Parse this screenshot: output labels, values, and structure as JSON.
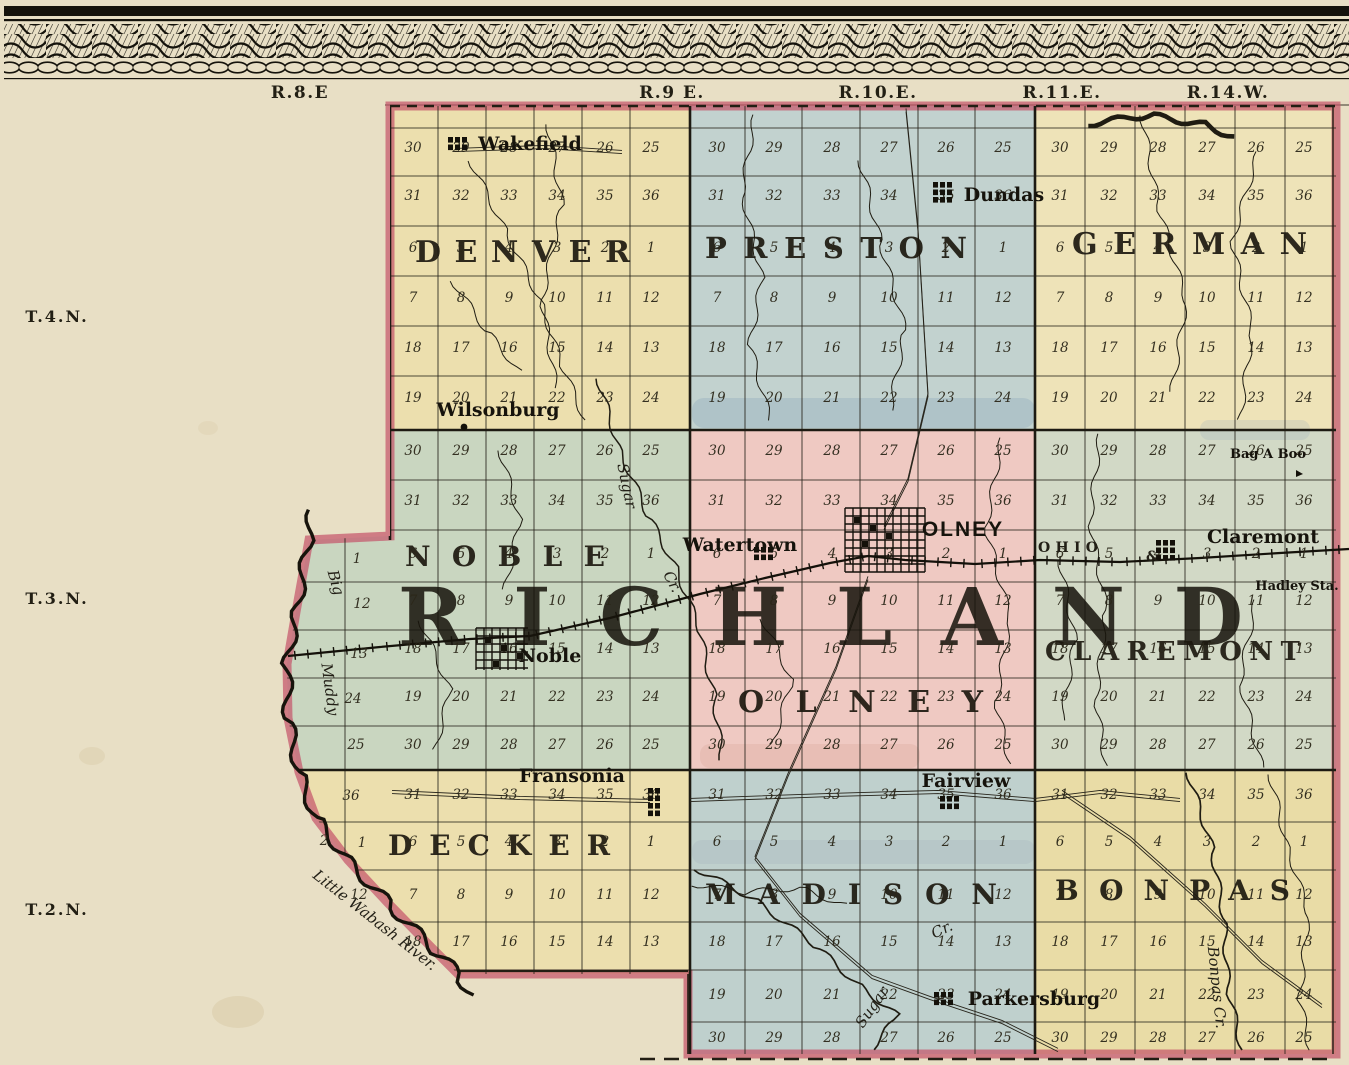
{
  "county_name": "RICHLAND",
  "palette": {
    "paper": "#e8dfc5",
    "ink": "#221e14",
    "red_border": "#c5566b",
    "water_wash": "#8aa3b8"
  },
  "margin": {
    "range_labels": [
      {
        "text": "R.8.E"
      },
      {
        "text": "R.9 E."
      },
      {
        "text": "R.10.E."
      },
      {
        "text": "R.11.E."
      },
      {
        "text": "R.14.W."
      }
    ],
    "township_row_labels": [
      {
        "text": "T.4.N."
      },
      {
        "text": "T.3.N."
      },
      {
        "text": "T.2.N."
      }
    ]
  },
  "townships": [
    {
      "name": "DENVER",
      "color": "#ecdfae"
    },
    {
      "name": "PRESTON",
      "color": "#c2d2cf"
    },
    {
      "name": "GERMAN",
      "color": "#eee3b8"
    },
    {
      "name": "NOBLE",
      "color": "#c9d6c0"
    },
    {
      "name": "OLNEY",
      "color": "#efc9c2"
    },
    {
      "name": "CLAREMONT",
      "color": "#d2d9c6"
    },
    {
      "name": "DECKER",
      "color": "#ecdfae"
    },
    {
      "name": "MADISON",
      "color": "#bfd0cd"
    },
    {
      "name": "BONPAS",
      "color": "#e9dca6"
    }
  ],
  "towns": [
    {
      "name": "Wakefield",
      "lx": 530,
      "ly": 150,
      "cls": "townlbl",
      "sym": "blockgrid",
      "sx": 448,
      "sy": 137,
      "sw": 22,
      "sh": 15
    },
    {
      "name": "Dundas",
      "lx": 1004,
      "ly": 201,
      "cls": "townlbl",
      "sym": "blockgrid",
      "sx": 933,
      "sy": 182,
      "sw": 24,
      "sh": 21
    },
    {
      "name": "Wilsonburg",
      "lx": 498,
      "ly": 416,
      "cls": "townlbl",
      "sym": "dot",
      "sx": 464,
      "sy": 427
    },
    {
      "name": "Watertown",
      "lx": 740,
      "ly": 551,
      "cls": "townlbl",
      "sym": "blockgrid",
      "sx": 754,
      "sy": 547,
      "sw": 26,
      "sh": 15
    },
    {
      "name": "OLNEY",
      "lx": 963,
      "ly": 536,
      "cls": "citylbl",
      "sym": "citygrid",
      "sx": 845,
      "sy": 508,
      "sw": 80,
      "sh": 64
    },
    {
      "name": "Claremont",
      "lx": 1263,
      "ly": 543,
      "cls": "townlbl",
      "sym": "blockgrid",
      "sx": 1156,
      "sy": 540,
      "sw": 26,
      "sh": 24
    },
    {
      "name": "Hadley Sta.",
      "lx": 1297,
      "ly": 590,
      "cls": "smalllbl",
      "sym": "none"
    },
    {
      "name": "Bag A Boo",
      "lx": 1268,
      "ly": 458,
      "cls": "smalllbl",
      "sym": "tick",
      "sx": 1296,
      "sy": 470
    },
    {
      "name": "Noble",
      "lx": 550,
      "ly": 662,
      "cls": "townlbl",
      "sym": "citygrid",
      "sx": 476,
      "sy": 628,
      "sw": 52,
      "sh": 42
    },
    {
      "name": "Fransonia",
      "lx": 572,
      "ly": 782,
      "cls": "townlbl",
      "sym": "blockgrid",
      "sx": 648,
      "sy": 788,
      "sw": 18,
      "sh": 28
    },
    {
      "name": "Fairview",
      "lx": 966,
      "ly": 787,
      "cls": "townlbl",
      "sym": "blockgrid",
      "sx": 940,
      "sy": 796,
      "sw": 22,
      "sh": 16
    },
    {
      "name": "Parkersburg",
      "lx": 1034,
      "ly": 1005,
      "cls": "townlbl",
      "sym": "blockgrid",
      "sx": 934,
      "sy": 992,
      "sw": 20,
      "sh": 15
    }
  ],
  "water_labels": [
    {
      "text": "Sugar",
      "x": 622,
      "y": 487,
      "rot": 78,
      "fs": 16
    },
    {
      "text": "Cr.",
      "x": 668,
      "y": 584,
      "rot": 62,
      "fs": 14
    },
    {
      "text": "Sugar",
      "x": 876,
      "y": 1010,
      "rot": -55,
      "fs": 16
    },
    {
      "text": "Cr.",
      "x": 944,
      "y": 934,
      "rot": -25,
      "fs": 14
    },
    {
      "text": "Bonpas Cr.",
      "x": 1212,
      "y": 988,
      "rot": 84,
      "fs": 15
    },
    {
      "text": "Little Wabash River.",
      "x": 372,
      "y": 924,
      "rot": 38,
      "fs": 17
    },
    {
      "text": "Big",
      "x": 331,
      "y": 584,
      "rot": 74,
      "fs": 14
    },
    {
      "text": "Muddy",
      "x": 325,
      "y": 690,
      "rot": 82,
      "fs": 14
    }
  ],
  "railroad_labels": [
    {
      "text": "OHIO",
      "x": 1038,
      "y": 552,
      "spread": 64
    },
    {
      "text": "&",
      "x": 1146,
      "y": 561
    }
  ],
  "sections": {
    "columns": {
      "denver": [
        413,
        461,
        509,
        557,
        605,
        651
      ],
      "preston": [
        717,
        774,
        832,
        889,
        946,
        1003
      ],
      "german": [
        1060,
        1109,
        1158,
        1207,
        1256,
        1304
      ]
    },
    "rows": [
      {
        "y": 152,
        "numbers": [
          30,
          29,
          28,
          27,
          26,
          25
        ],
        "groups": [
          "denver",
          "preston",
          "german"
        ]
      },
      {
        "y": 200,
        "numbers": [
          31,
          32,
          33,
          34,
          35,
          36
        ],
        "groups": [
          "denver",
          "preston",
          "german"
        ]
      },
      {
        "y": 252,
        "numbers": [
          6,
          5,
          4,
          3,
          2,
          1
        ],
        "groups": [
          "denver",
          "preston",
          "german"
        ]
      },
      {
        "y": 302,
        "numbers": [
          7,
          8,
          9,
          10,
          11,
          12
        ],
        "groups": [
          "denver",
          "preston",
          "german"
        ]
      },
      {
        "y": 352,
        "numbers": [
          18,
          17,
          16,
          15,
          14,
          13
        ],
        "groups": [
          "denver",
          "preston",
          "german"
        ]
      },
      {
        "y": 402,
        "numbers": [
          19,
          20,
          21,
          22,
          23,
          24
        ],
        "groups": [
          "denver",
          "preston",
          "german"
        ]
      },
      {
        "y": 455,
        "numbers": [
          30,
          29,
          28,
          27,
          26,
          25
        ],
        "groups": [
          "denver",
          "preston",
          "german"
        ]
      },
      {
        "y": 505,
        "numbers": [
          31,
          32,
          33,
          34,
          35,
          36
        ],
        "groups": [
          "denver",
          "preston",
          "german"
        ]
      },
      {
        "y": 558,
        "numbers": [
          6,
          5,
          4,
          3,
          2,
          1
        ],
        "groups": [
          "denver",
          "preston",
          "german"
        ]
      },
      {
        "y": 605,
        "numbers": [
          7,
          8,
          9,
          10,
          11,
          12
        ],
        "groups": [
          "denver",
          "preston",
          "german"
        ]
      },
      {
        "y": 653,
        "numbers": [
          18,
          17,
          16,
          15,
          14,
          13
        ],
        "groups": [
          "denver",
          "preston",
          "german"
        ]
      },
      {
        "y": 701,
        "numbers": [
          19,
          20,
          21,
          22,
          23,
          24
        ],
        "groups": [
          "denver",
          "preston",
          "german"
        ]
      },
      {
        "y": 749,
        "numbers": [
          30,
          29,
          28,
          27,
          26,
          25
        ],
        "groups": [
          "denver",
          "preston",
          "german"
        ]
      },
      {
        "y": 799,
        "numbers": [
          31,
          32,
          33,
          34,
          35,
          36
        ],
        "groups": [
          "denver",
          "preston",
          "german"
        ]
      },
      {
        "y": 846,
        "numbers": [
          6,
          5,
          4,
          3,
          2,
          1
        ],
        "groups": [
          "denver",
          "preston",
          "german"
        ]
      },
      {
        "y": 899,
        "numbers": [
          7,
          8,
          9,
          10,
          11,
          12
        ],
        "groups": [
          "denver",
          "preston",
          "german"
        ]
      },
      {
        "y": 946,
        "numbers": [
          18,
          17,
          16,
          15,
          14,
          13
        ],
        "groups": [
          "denver",
          "preston",
          "german"
        ]
      },
      {
        "y": 999,
        "numbers": [
          19,
          20,
          21,
          22,
          23,
          24
        ],
        "groups": [
          "preston",
          "german"
        ]
      },
      {
        "y": 1042,
        "numbers": [
          30,
          29,
          28,
          27,
          26,
          25
        ],
        "groups": [
          "preston",
          "german"
        ]
      }
    ],
    "west_numbers": [
      {
        "x": 357,
        "y": 563,
        "n": "1"
      },
      {
        "x": 362,
        "y": 608,
        "n": "12"
      },
      {
        "x": 359,
        "y": 658,
        "n": "13"
      },
      {
        "x": 353,
        "y": 703,
        "n": "24"
      },
      {
        "x": 356,
        "y": 749,
        "n": "25"
      },
      {
        "x": 351,
        "y": 800,
        "n": "36"
      },
      {
        "x": 324,
        "y": 845,
        "n": "2"
      },
      {
        "x": 362,
        "y": 847,
        "n": "1"
      },
      {
        "x": 359,
        "y": 899,
        "n": "12"
      }
    ]
  }
}
